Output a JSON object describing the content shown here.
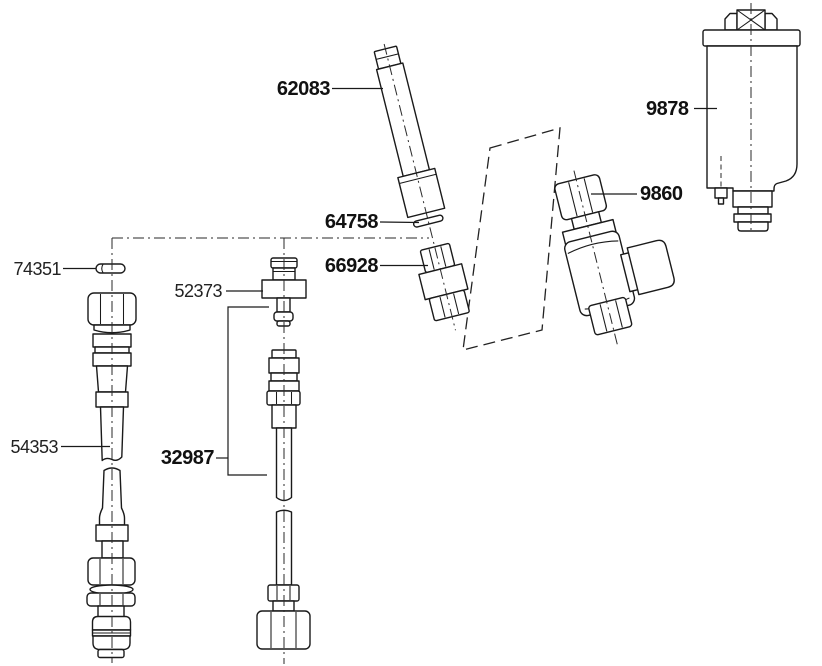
{
  "diagram": {
    "background": "#ffffff",
    "line_color": "#1a1a1a"
  },
  "labels": {
    "p62083": "62083",
    "p64758": "64758",
    "p66928": "66928",
    "p74351": "74351",
    "p52373": "52373",
    "p54353": "54353",
    "p32987": "32987",
    "p9860": "9860",
    "p9878": "9878"
  }
}
